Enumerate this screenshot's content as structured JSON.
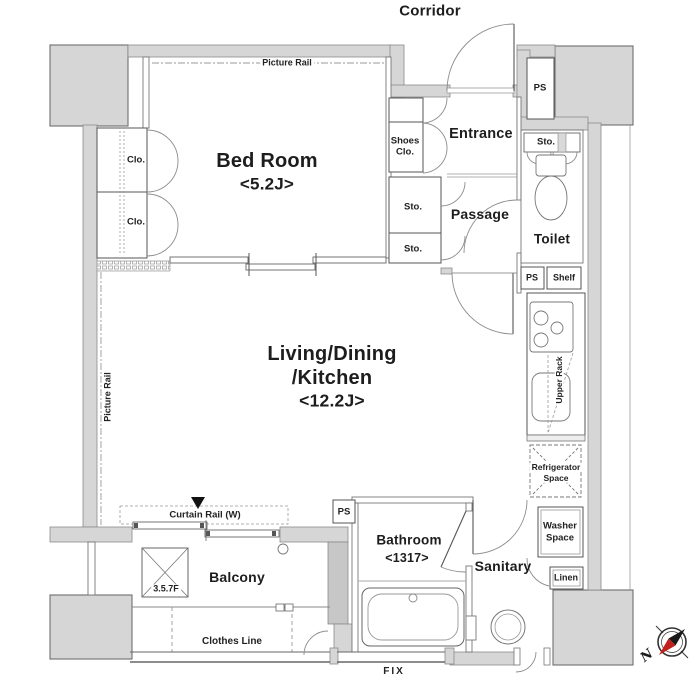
{
  "colors": {
    "wall_fill": "#d6d6d6",
    "wall_stroke": "#6e6e6e",
    "line": "#555555",
    "compass_red": "#c2201d"
  },
  "compass": {
    "north_label": "N"
  },
  "rooms": {
    "corridor": {
      "name": "Corridor"
    },
    "bedroom": {
      "name": "Bed Room",
      "size": "<5.2J>"
    },
    "ldk": {
      "name_line1": "Living/Dining",
      "name_line2": "/Kitchen",
      "size": "<12.2J>"
    },
    "entrance": {
      "name": "Entrance"
    },
    "passage": {
      "name": "Passage"
    },
    "toilet": {
      "name": "Toilet"
    },
    "bathroom": {
      "name": "Bathroom",
      "size": "<1317>"
    },
    "sanitary": {
      "name": "Sanitary"
    },
    "balcony": {
      "name": "Balcony"
    }
  },
  "features": {
    "picture_rail_top": "Picture Rail",
    "picture_rail_left": "Picture Rail",
    "closet_upper": "Clo.",
    "closet_lower": "Clo.",
    "shoes_closet": [
      "Shoes",
      "Clo."
    ],
    "storage_above_toilet": "Sto.",
    "storage_passage_upper": "Sto.",
    "storage_passage_lower": "Sto.",
    "ps_corridor": "PS",
    "ps_kitchen": "PS",
    "ps_balcony": "PS",
    "shelf": "Shelf",
    "upper_rack": "Upper Rack",
    "refrigerator_space": [
      "Refrigerator",
      "Space"
    ],
    "washer_space": [
      "Washer",
      "Space"
    ],
    "linen": "Linen",
    "curtain_rail": "Curtain Rail (W)",
    "balcony_hatch": "3.5.7F",
    "clothes_line": "Clothes Line",
    "fix_window": "FIX"
  }
}
